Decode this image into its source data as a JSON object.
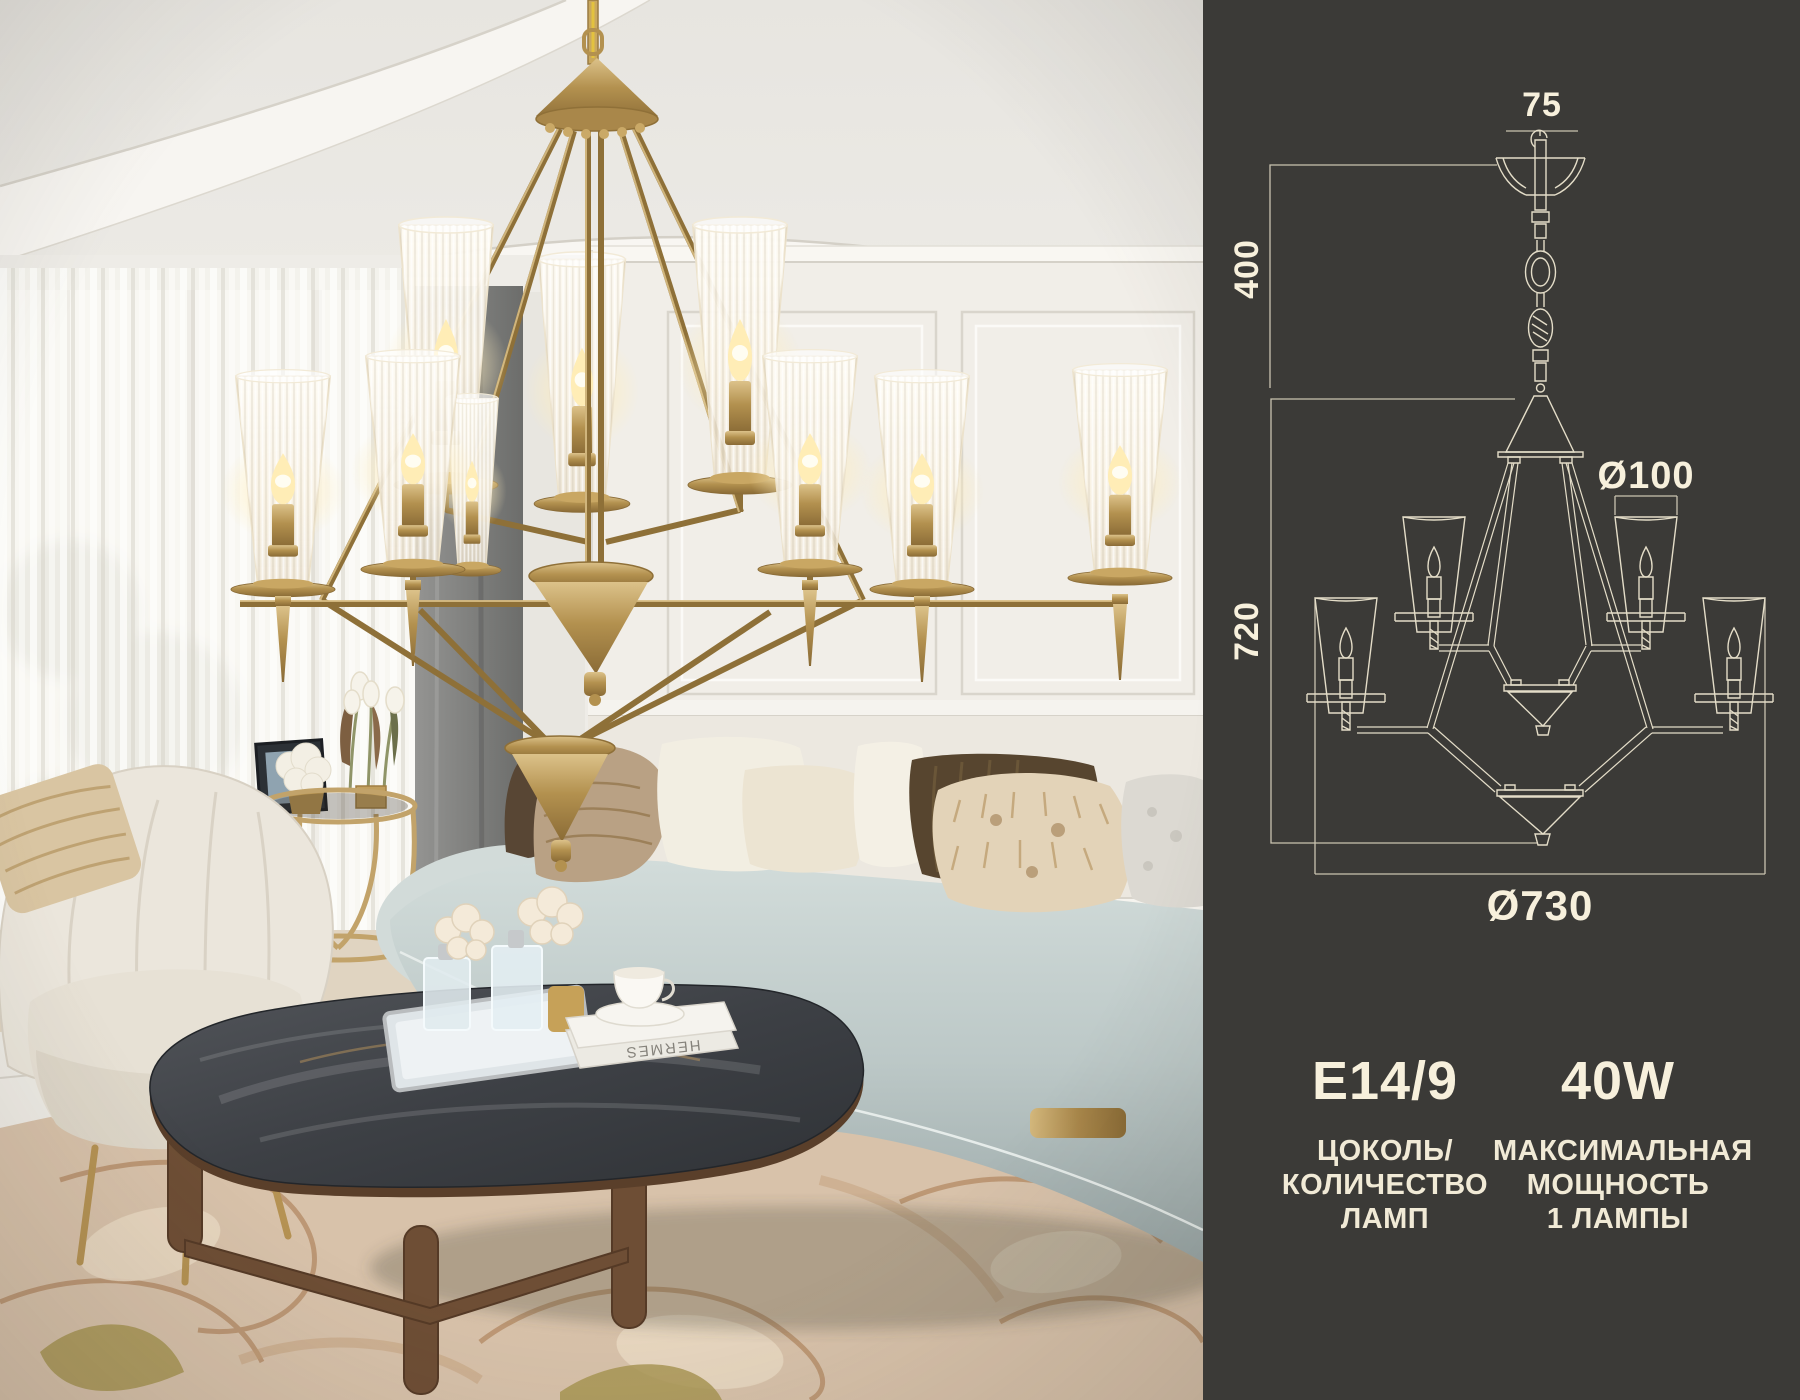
{
  "meta": {
    "description": "Brass two-tier chandelier product image: lifestyle photo with lit chandelier over a living room, plus dark technical panel with dimensioned line drawing and lamp specifications"
  },
  "photo": {
    "book_spine_text": "HERMES"
  },
  "panel": {
    "bg": "#3b3a37",
    "text_color": "#f7f0dc",
    "line_color": "#e4ddc8",
    "dimensions": {
      "hook": "75",
      "suspension": "400",
      "body": "720",
      "shade": "Ø100",
      "diameter": "Ø730"
    },
    "specs": [
      {
        "value": "E14/9",
        "lines": [
          "ЦОКОЛЬ/",
          "КОЛИЧЕСТВО",
          "ЛАМП"
        ]
      },
      {
        "value": "40W",
        "lines": [
          "МАКСИМАЛЬНАЯ",
          "МОЩНОСТЬ",
          "1 ЛАМПЫ"
        ]
      }
    ]
  }
}
